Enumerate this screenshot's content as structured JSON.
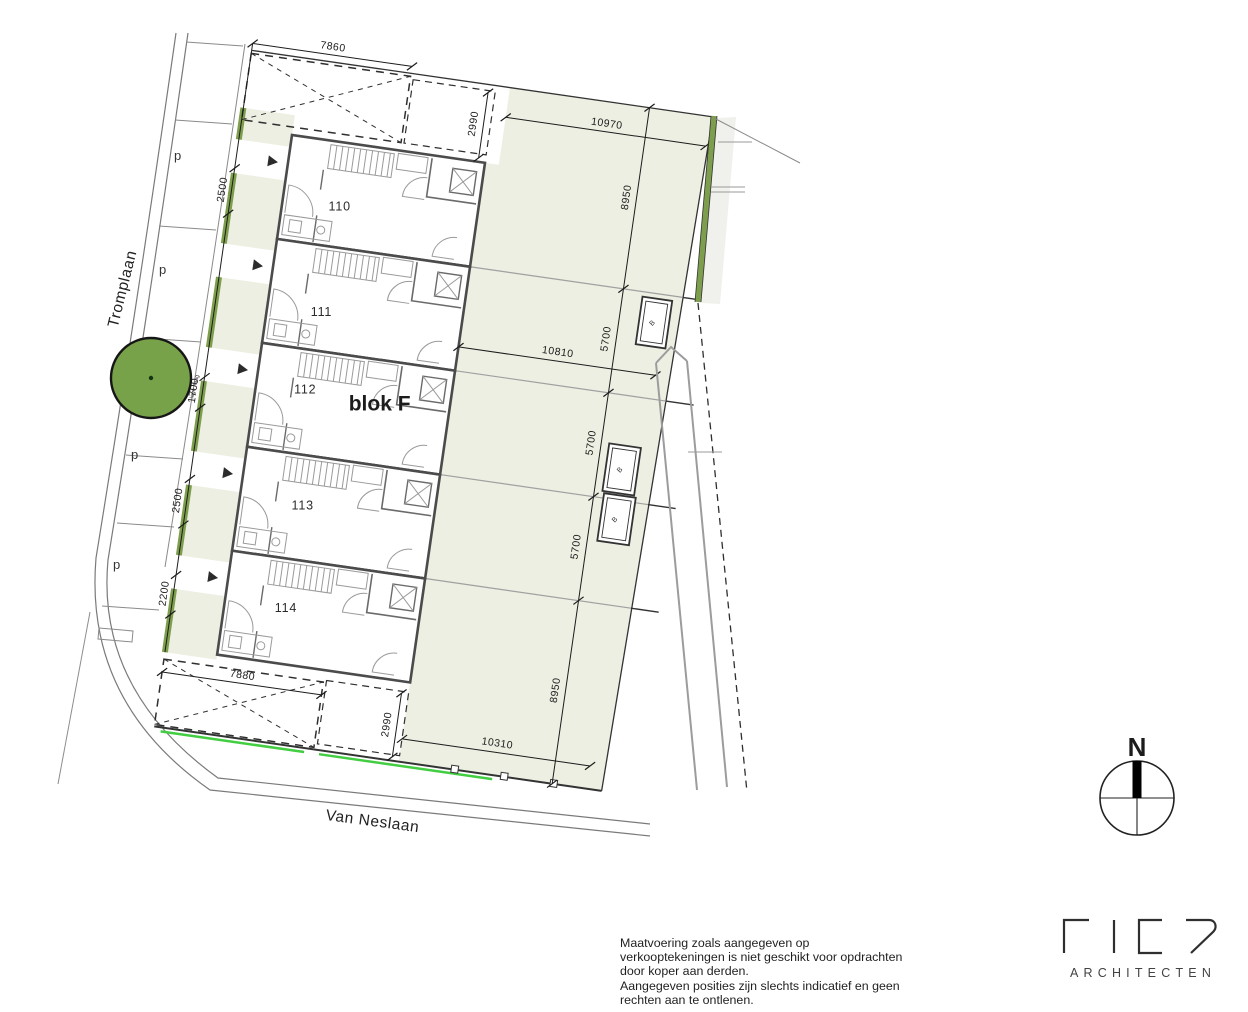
{
  "streets": {
    "tromplaan": "Tromplaan",
    "van_neslaan": "Van Neslaan"
  },
  "block": {
    "label": "blok F",
    "units": [
      "110",
      "111",
      "112",
      "113",
      "114"
    ]
  },
  "parking": {
    "labels": [
      "p",
      "p",
      "p",
      "p"
    ]
  },
  "sheds": {
    "labels": [
      "B",
      "B",
      "B"
    ]
  },
  "landscape": {
    "hedge_note": "lage haag"
  },
  "compass": {
    "label": "N"
  },
  "dims": {
    "t7860": "7860",
    "t2990": "2990",
    "t10970": "10970",
    "r8950a": "8950",
    "r5700a": "5700",
    "r5700b": "5700",
    "r5700c": "5700",
    "r8950b": "8950",
    "l2500a": "2500",
    "l1700": "1700",
    "l2500b": "2500",
    "l2200": "2200",
    "m10810": "10810",
    "b10310": "10310",
    "b7880": "7880",
    "b2990": "2990"
  },
  "logo": {
    "name": "FIER",
    "subtitle": "ARCHITECTEN"
  },
  "disclaimer": {
    "lines": [
      "Maatvoering zoals aangegeven op",
      "verkooptekeningen is niet geschikt voor opdrachten",
      "door koper aan derden.",
      "Aangegeven posities zijn slechts indicatief en geen",
      "rechten aan te ontlenen."
    ]
  },
  "colors": {
    "garden": "#ecefe2",
    "hedge": "#7d9e4c",
    "accent_red": "#e8252c",
    "bright_green": "#42cd42",
    "wall": "#4b4b4b"
  }
}
